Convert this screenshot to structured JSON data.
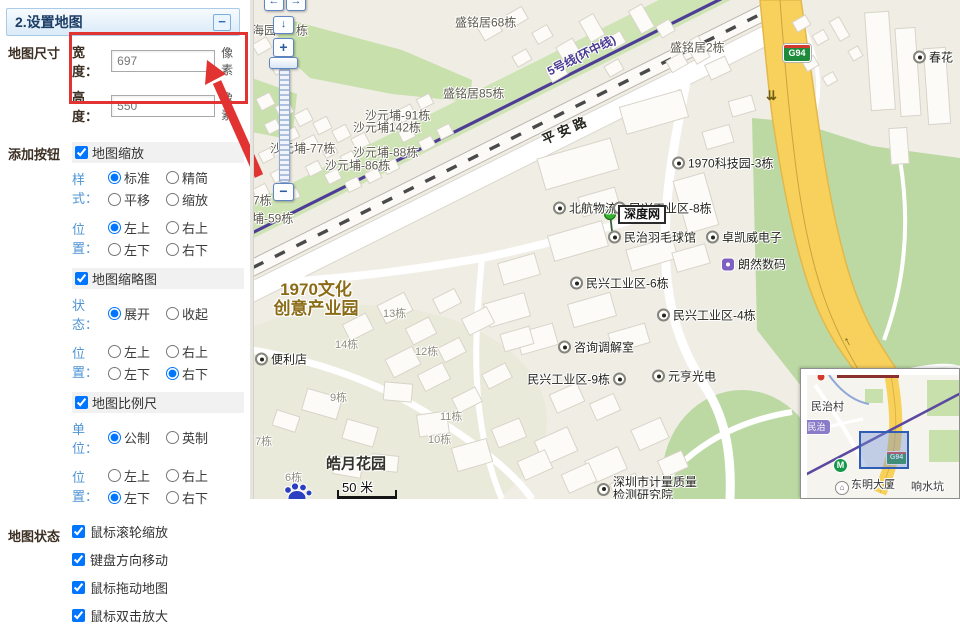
{
  "panel": {
    "title": "2.设置地图",
    "collapse_glyph": "−",
    "size": {
      "section": "地图尺寸",
      "rows": [
        {
          "label": "宽度：",
          "value": "697",
          "unit": "像素"
        },
        {
          "label": "高度：",
          "value": "550",
          "unit": "像素"
        }
      ]
    },
    "add_buttons": {
      "section": "添加按钮",
      "zoom": {
        "label": "地图缩放",
        "checked": true,
        "style": {
          "label": "样式：",
          "options": [
            {
              "t": "标准",
              "s": true
            },
            {
              "t": "精简",
              "s": false
            },
            {
              "t": "平移",
              "s": false
            },
            {
              "t": "缩放",
              "s": false
            }
          ]
        },
        "pos": {
          "label": "位置：",
          "options": [
            {
              "t": "左上",
              "s": true
            },
            {
              "t": "右上",
              "s": false
            },
            {
              "t": "左下",
              "s": false
            },
            {
              "t": "右下",
              "s": false
            }
          ]
        }
      },
      "overview": {
        "label": "地图缩略图",
        "checked": true,
        "state": {
          "label": "状态：",
          "options": [
            {
              "t": "展开",
              "s": true
            },
            {
              "t": "收起",
              "s": false
            }
          ]
        },
        "pos": {
          "label": "位置：",
          "options": [
            {
              "t": "左上",
              "s": false
            },
            {
              "t": "右上",
              "s": false
            },
            {
              "t": "左下",
              "s": false
            },
            {
              "t": "右下",
              "s": true
            }
          ]
        }
      },
      "scale": {
        "label": "地图比例尺",
        "checked": true,
        "unit": {
          "label": "单位：",
          "options": [
            {
              "t": "公制",
              "s": true
            },
            {
              "t": "英制",
              "s": false
            }
          ]
        },
        "pos": {
          "label": "位置：",
          "options": [
            {
              "t": "左上",
              "s": false
            },
            {
              "t": "右上",
              "s": false
            },
            {
              "t": "左下",
              "s": true
            },
            {
              "t": "右下",
              "s": false
            }
          ]
        }
      }
    },
    "map_state": {
      "section": "地图状态",
      "items": [
        {
          "t": "鼠标滚轮缩放",
          "s": true
        },
        {
          "t": "键盘方向移动",
          "s": true
        },
        {
          "t": "鼠标拖动地图",
          "s": true
        },
        {
          "t": "鼠标双击放大",
          "s": true
        }
      ]
    },
    "annotation_color": "#e23333"
  },
  "map": {
    "zoom_control": {
      "left": "←",
      "right": "→",
      "down": "↓",
      "zoom_in": "+",
      "zoom_out": "−"
    },
    "metro_label": "5号线(环中线)",
    "road_label": "平安路",
    "g94_label": "G94",
    "oneway_glyph": "⇊",
    "marker": {
      "label": "深度网"
    },
    "area_label": {
      "line1": "1970文化",
      "line2": "创意产业园",
      "color": "#8a6b16"
    },
    "scale_bar": {
      "text": "50 米"
    },
    "bottom_poi": {
      "line1": "深圳市计量质量",
      "line2": "检测研究院"
    },
    "pois": [
      {
        "t": "海园",
        "x": 0,
        "y": 30,
        "type": "text"
      },
      {
        "t": "栋",
        "x": 44,
        "y": 30,
        "type": "text"
      },
      {
        "t": "盛铭居68栋",
        "x": 203,
        "y": 22,
        "type": "text"
      },
      {
        "t": "盛铭居2栋",
        "x": 418,
        "y": 47,
        "type": "text"
      },
      {
        "t": "盛铭居85栋",
        "x": 191,
        "y": 93,
        "type": "text"
      },
      {
        "t": "沙元埔-91栋",
        "x": 113,
        "y": 115,
        "type": "text"
      },
      {
        "t": "沙元埔142栋",
        "x": 101,
        "y": 127,
        "type": "text"
      },
      {
        "t": "沙元埔-77栋",
        "x": 18,
        "y": 148,
        "type": "text"
      },
      {
        "t": "沙元埔-88栋",
        "x": 101,
        "y": 152,
        "type": "text"
      },
      {
        "t": "沙元埔-86栋",
        "x": 73,
        "y": 165,
        "type": "text"
      },
      {
        "t": "7栋",
        "x": 1,
        "y": 200,
        "type": "text"
      },
      {
        "t": "埔-59栋",
        "x": 0,
        "y": 218,
        "type": "text"
      },
      {
        "t": "1970科技园-3栋",
        "x": 420,
        "y": 163,
        "type": "dot"
      },
      {
        "t": "北航物流",
        "x": 301,
        "y": 208,
        "type": "dot"
      },
      {
        "t": "民兴工业区-8栋",
        "x": 361,
        "y": 208,
        "type": "dot"
      },
      {
        "t": "民治羽毛球馆",
        "x": 356,
        "y": 237,
        "type": "dot"
      },
      {
        "t": "卓凯威电子",
        "x": 454,
        "y": 237,
        "type": "dot"
      },
      {
        "t": "朗然数码",
        "x": 469,
        "y": 264,
        "type": "purple"
      },
      {
        "t": "民兴工业区-6栋",
        "x": 318,
        "y": 283,
        "type": "dot"
      },
      {
        "t": "民兴工业区-4栋",
        "x": 405,
        "y": 315,
        "type": "dot"
      },
      {
        "t": "咨询调解室",
        "x": 306,
        "y": 347,
        "type": "dot"
      },
      {
        "t": "民兴工业区-9栋",
        "x": 362,
        "y": 379,
        "type": "dot",
        "side": "left"
      },
      {
        "t": "元亨光电",
        "x": 400,
        "y": 376,
        "type": "dot"
      },
      {
        "t": "便利店",
        "x": 3,
        "y": 359,
        "type": "dot"
      },
      {
        "t": "春花",
        "x": 661,
        "y": 57,
        "type": "dot"
      },
      {
        "t": "13栋",
        "x": 131,
        "y": 313,
        "type": "grey"
      },
      {
        "t": "14栋",
        "x": 83,
        "y": 344,
        "type": "grey"
      },
      {
        "t": "12栋",
        "x": 163,
        "y": 351,
        "type": "grey"
      },
      {
        "t": "9栋",
        "x": 78,
        "y": 397,
        "type": "grey"
      },
      {
        "t": "11栋",
        "x": 188,
        "y": 416,
        "type": "grey"
      },
      {
        "t": "10栋",
        "x": 176,
        "y": 439,
        "type": "grey"
      },
      {
        "t": "7栋",
        "x": 3,
        "y": 441,
        "type": "grey"
      },
      {
        "t": "6栋",
        "x": 33,
        "y": 477,
        "type": "grey"
      },
      {
        "t": "皓月花园",
        "x": 74,
        "y": 463,
        "type": "big"
      }
    ],
    "minimap": {
      "village": "民治村",
      "station": "民治",
      "building": "东明大厦",
      "place": "响水坑",
      "g94": "G94",
      "metro_glyph": "M",
      "building_glyph": "⌂"
    },
    "colors": {
      "green": "#c8e0ab",
      "metro_purple": "#4e3d96",
      "road_yellow": "#f8d05c"
    }
  }
}
